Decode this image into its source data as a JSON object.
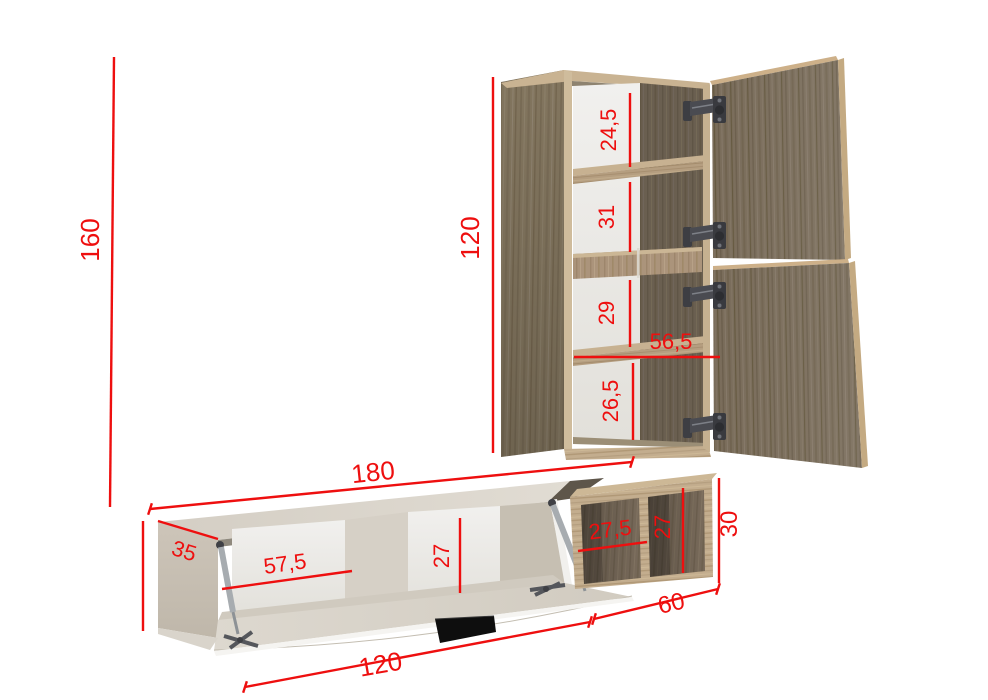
{
  "drawing": {
    "type": "furniture-dimension-diagram",
    "units": "cm"
  },
  "colors": {
    "dimension": "#ee0f0f",
    "background": "#ffffff",
    "carcass_beige": "#d8d3ca",
    "wood_dark": "#796c5a",
    "wood_light": "#c3ad8e",
    "back_panel": "#eeedeb",
    "handle_black": "#0e0e0e"
  },
  "dimensions": {
    "total_height": "160",
    "cabinet_height": "120",
    "cabinet_section_1": "24,5",
    "cabinet_section_2": "31",
    "cabinet_section_3": "29",
    "cabinet_shelf_width": "56,5",
    "cabinet_section_4": "26,5",
    "stand_width": "180",
    "stand_depth": "35",
    "stand_bay_width": "57,5",
    "stand_inner_height": "27",
    "unit_bay_width": "27,5",
    "unit_bay_height": "27",
    "unit_height": "30",
    "unit_width": "60",
    "flap_width": "120"
  }
}
